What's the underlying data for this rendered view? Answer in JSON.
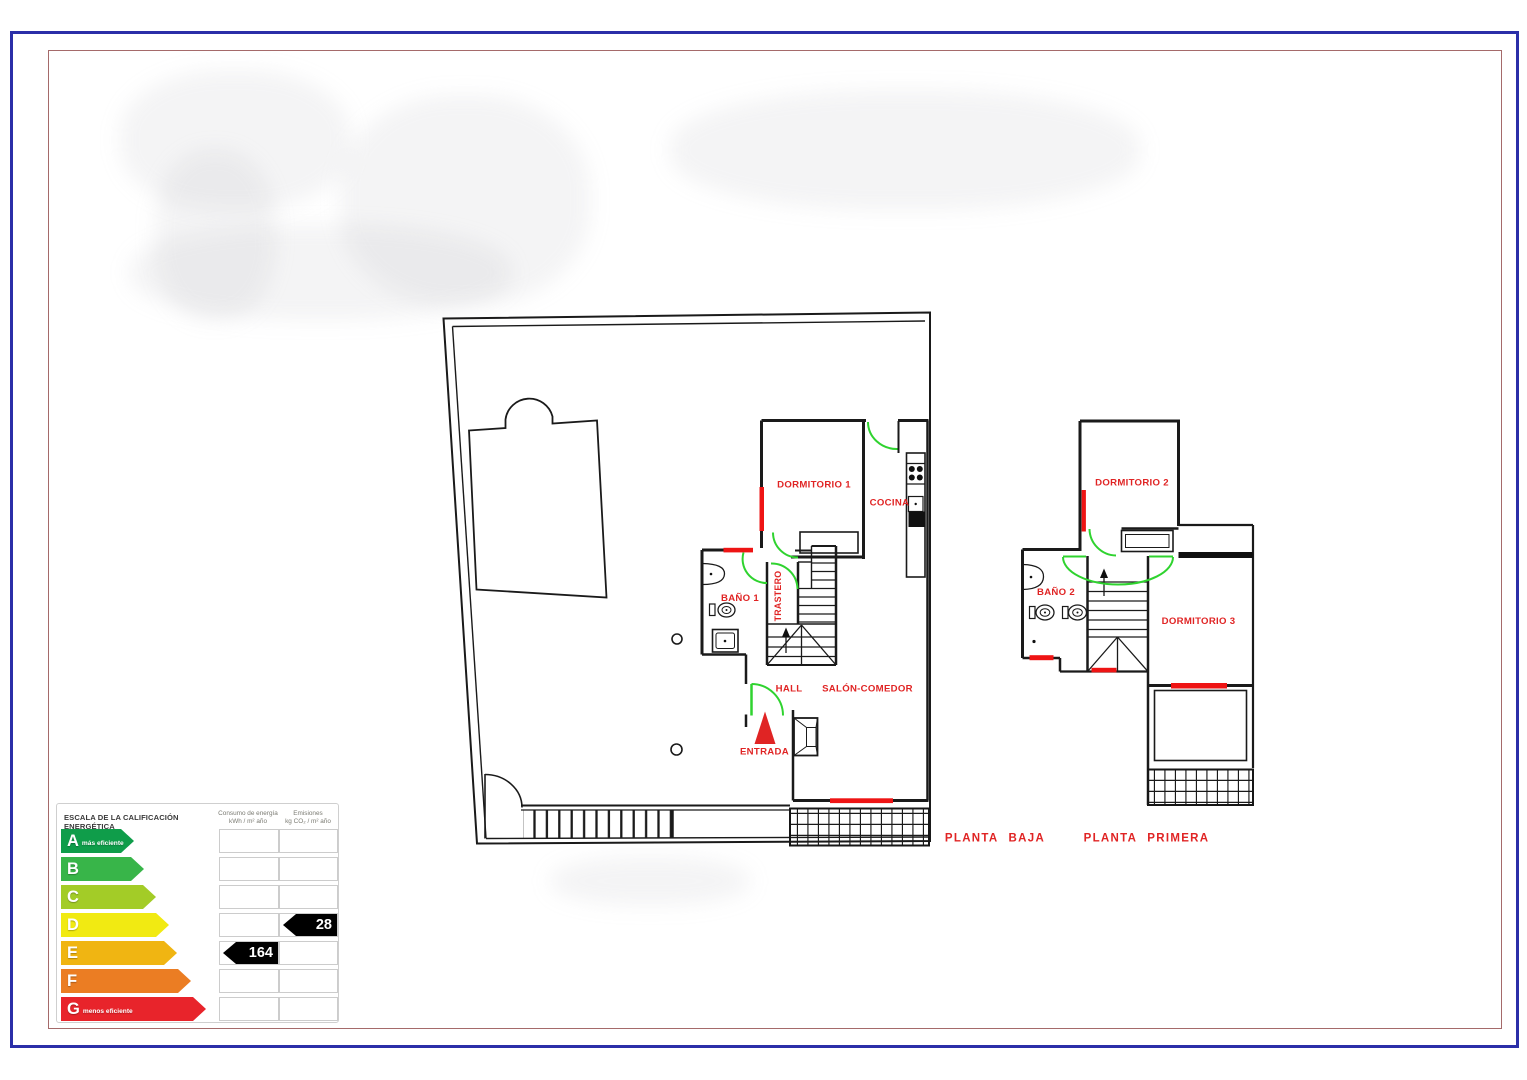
{
  "canvas": {
    "width": 1527,
    "height": 1080
  },
  "borders": {
    "outer_color": "#2b2fa8",
    "inner_color": "#a56a6a"
  },
  "floor_plans": {
    "wall_color": "#1a1a1a",
    "door_color": "#2fd32f",
    "window_color": "#ee1414",
    "label_color": "#e02424",
    "ground_floor": {
      "title": "PLANTA BAJA",
      "labels": {
        "dormitorio1": "DORMITORIO 1",
        "cocina": "COCINA",
        "bano1": "BAÑO 1",
        "trastero": "TRASTERO",
        "hall": "HALL",
        "salon": "SALÓN-COMEDOR",
        "entrada": "ENTRADA"
      }
    },
    "first_floor": {
      "title": "PLANTA PRIMERA",
      "labels": {
        "dormitorio2": "DORMITORIO 2",
        "bano2": "BAÑO 2",
        "dormitorio3": "DORMITORIO 3"
      }
    }
  },
  "energy_label": {
    "title": "ESCALA DE LA CALIFICACIÓN ENERGÉTICA",
    "consumption_header_line1": "Consumo de energía",
    "consumption_header_line2": "kWh / m² año",
    "emissions_header_line1": "Emisiones",
    "emissions_header_line2": "kg CO₂ / m² año",
    "rows": [
      {
        "letter": "A",
        "note": "más eficiente",
        "color": "#0f9d4a",
        "band_width": 73
      },
      {
        "letter": "B",
        "note": "",
        "color": "#38b549",
        "band_width": 83
      },
      {
        "letter": "C",
        "note": "",
        "color": "#a3cc27",
        "band_width": 95
      },
      {
        "letter": "D",
        "note": "",
        "color": "#f1ea12",
        "band_width": 108
      },
      {
        "letter": "E",
        "note": "",
        "color": "#f0b512",
        "band_width": 116
      },
      {
        "letter": "F",
        "note": "",
        "color": "#eb7d23",
        "band_width": 130
      },
      {
        "letter": "G",
        "note": "menos eficiente",
        "color": "#e8242b",
        "band_width": 145
      }
    ],
    "consumption_value": "164",
    "consumption_row": 4,
    "emissions_value": "28",
    "emissions_row": 3
  }
}
